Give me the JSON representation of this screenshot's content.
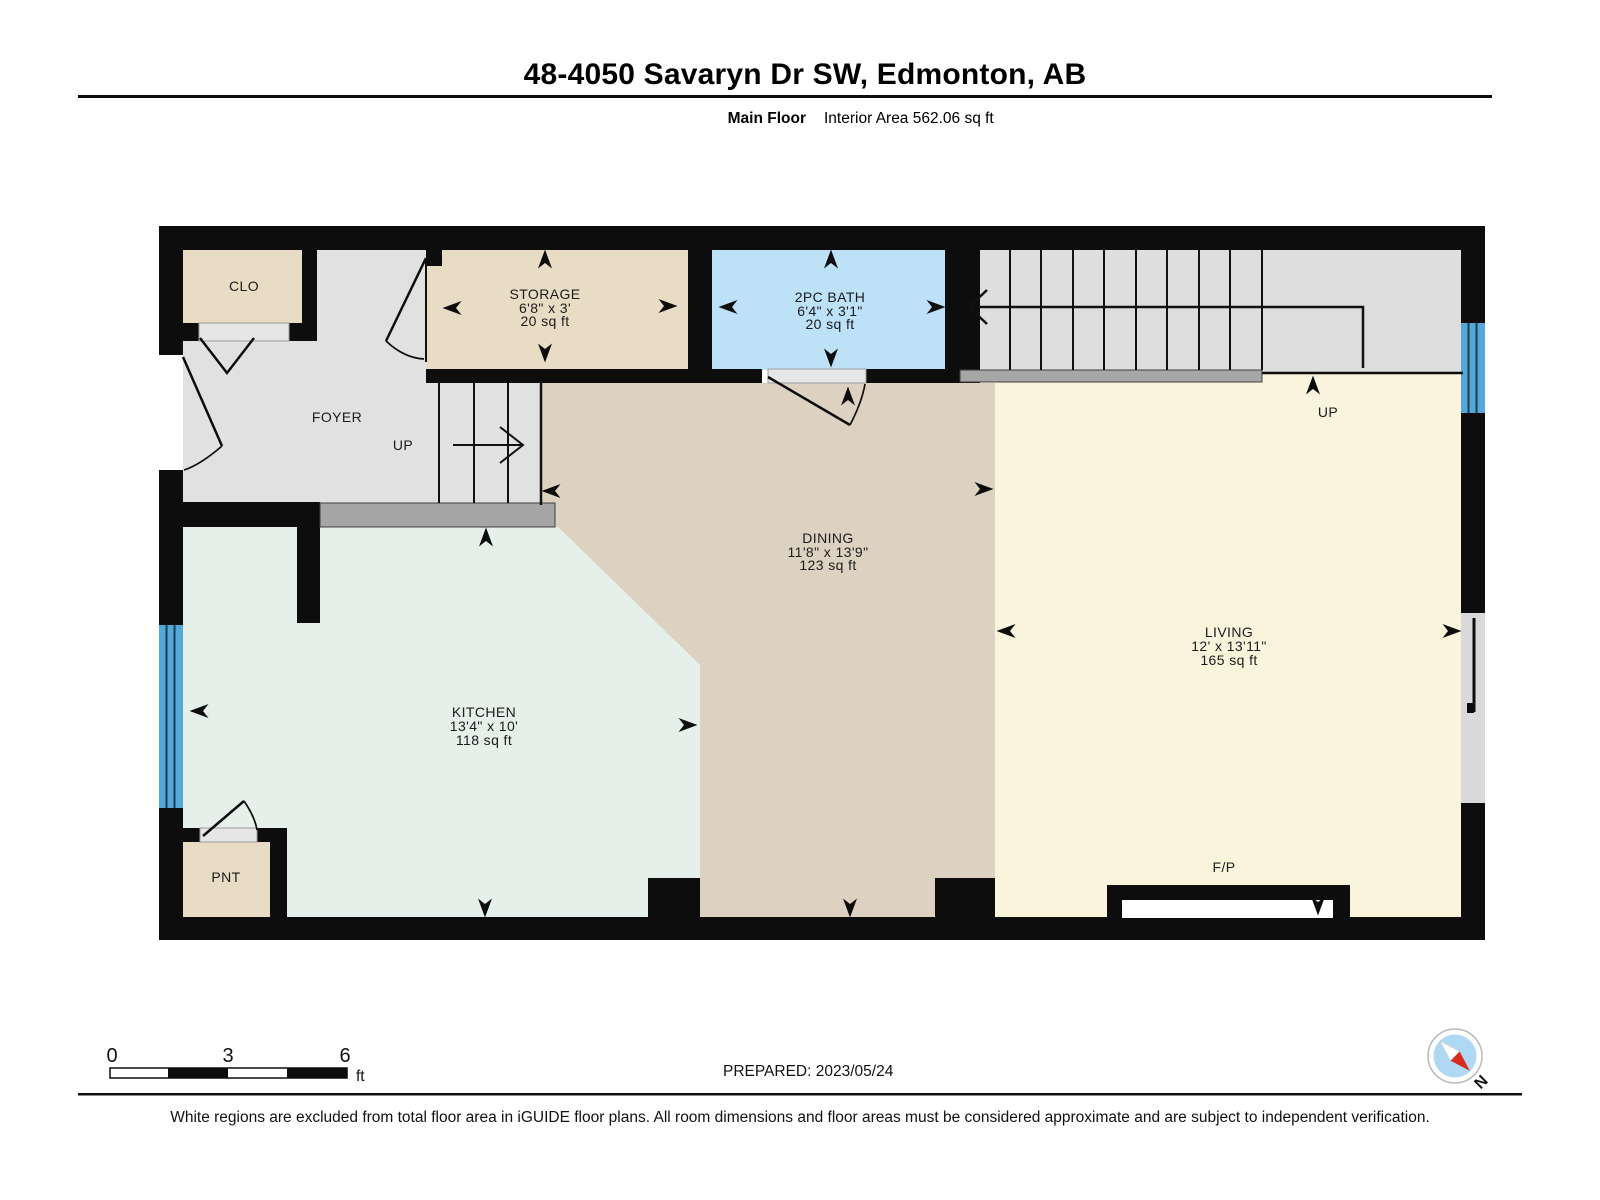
{
  "header": {
    "title": "48-4050 Savaryn Dr SW, Edmonton, AB",
    "floor_label": "Main Floor",
    "area_label": "Interior Area 562.06 sq ft"
  },
  "rooms": {
    "closet": {
      "name": "CLO"
    },
    "foyer": {
      "name": "FOYER"
    },
    "storage": {
      "name": "STORAGE",
      "dims": "6'8\" x 3'",
      "area": "20 sq ft"
    },
    "bath": {
      "name": "2PC BATH",
      "dims": "6'4\" x 3'1\"",
      "area": "20 sq ft"
    },
    "dining": {
      "name": "DINING",
      "dims": "11'8\" x 13'9\"",
      "area": "123 sq ft"
    },
    "living": {
      "name": "LIVING",
      "dims": "12' x 13'11\"",
      "area": "165 sq ft"
    },
    "kitchen": {
      "name": "KITCHEN",
      "dims": "13'4\" x 10'",
      "area": "118 sq ft"
    },
    "pantry": {
      "name": "PNT"
    },
    "fireplace_label": "F/P",
    "stair_up_foyer": "UP",
    "stair_up_landing": "UP"
  },
  "scale_bar": {
    "ticks": [
      "0",
      "3",
      "6"
    ],
    "unit": "ft"
  },
  "prepared_label": "PREPARED: 2023/05/24",
  "compass": {
    "north_label": "N"
  },
  "footer": {
    "disclaimer": "White regions are excluded from total floor area in iGUIDE floor plans. All room dimensions and floor areas must be considered approximate and are subject to independent verification."
  },
  "colors": {
    "wall": "#0d0d0d",
    "room_beige": "#e9dcc4",
    "dining_tan": "#ddd2c1",
    "living_cream": "#fbf4dc",
    "kitchen_mint": "#e4f0e9",
    "bath_blue": "#bde2f8",
    "floor_gray": "#e1e1e1",
    "bar_gray": "#a6a6a6",
    "window_blue": "#55a9d9",
    "compass_red": "#d92b1f",
    "compass_blue": "#aed8f3"
  }
}
